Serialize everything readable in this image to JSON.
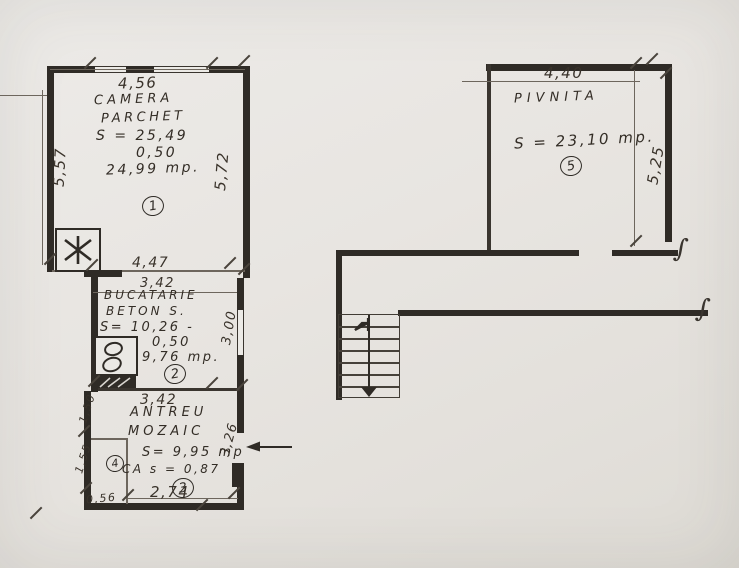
{
  "drawing": {
    "kind": "hand-drawn floor plan",
    "colors": {
      "paper": "#e8e5e1",
      "ink": "#2f2b26"
    }
  },
  "rooms": {
    "camera": {
      "name1": "CAMERA",
      "name2": "PARCHET",
      "area1": "S = 25,49",
      "area2": "0,50",
      "area3": "24,99 mp.",
      "number": "1"
    },
    "bucatarie": {
      "name1": "BUCATARIE",
      "name2": "BETON S.",
      "area1": "S= 10,26 -",
      "area2": "0,50",
      "area3": "9,76 mp.",
      "number": "2"
    },
    "antreu": {
      "name1": "ANTREU",
      "name2": "MOZAIC",
      "area1": "S= 9,95 mp",
      "area2": "CA s = 0,87",
      "number": "3"
    },
    "closet": {
      "number": "4"
    },
    "pivnita": {
      "name1": "PIVNITA",
      "area1": "S = 23,10 mp.",
      "number": "5"
    }
  },
  "dimensions": {
    "camera_top": "4,56",
    "camera_left": "5,57",
    "camera_right": "5,72",
    "kitchen_top_outer": "4,47",
    "kitchen_top_inner": "3,42",
    "kitchen_window": "3,00",
    "kitchen_bottom": "3,42",
    "antreu_left_upper": "1,50",
    "antreu_left_lower": "1,55",
    "antreu_right": "3,26",
    "antreu_bottom_left": "0,56",
    "antreu_bottom": "2,74",
    "pivnita_top": "4,40",
    "pivnita_right": "5,25"
  }
}
